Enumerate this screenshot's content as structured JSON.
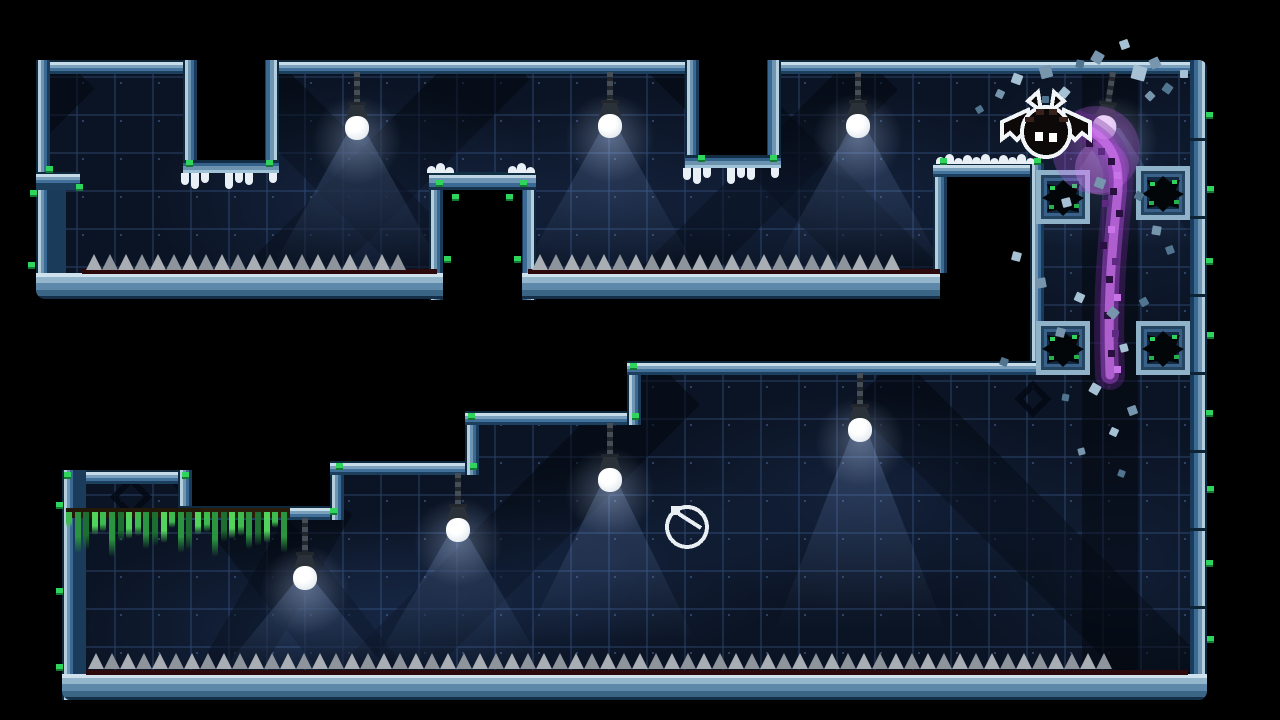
{
  "viewport": {
    "width": 1280,
    "height": 720,
    "background": "#000000"
  },
  "palette": {
    "tile_base": "#0b1424",
    "tile_grid": "#2c4268",
    "border_light": "#c6dbe8",
    "border_mid": "#41719a",
    "border_dark": "#1c3f5e",
    "spike_light": "#a9aeb5",
    "spike_dark": "#8d949c",
    "spike_base_red": "#2e090c",
    "moss_green": "#2fd45c",
    "vine_green": "#3dbb4e",
    "snow_white": "#e9f0f5",
    "lamp_bulb": "#edf1f5",
    "trail_purple": "#a755cc",
    "debris_blue": "#a6c1d4",
    "bat_body": "#0c0908",
    "bat_outline": "#f2f5f7"
  },
  "entities": {
    "bat_player": {
      "x": 998,
      "y": 92,
      "width": 96,
      "height": 68,
      "facing": "left"
    },
    "clock_pickup": {
      "cx": 687,
      "cy": 527,
      "r": 20
    },
    "lamps": [
      {
        "x": 357,
        "attach": 72,
        "bulb": 128,
        "tilt": 0,
        "cone": 140
      },
      {
        "x": 610,
        "attach": 72,
        "bulb": 126,
        "tilt": 0,
        "cone": 140
      },
      {
        "x": 858,
        "attach": 72,
        "bulb": 126,
        "tilt": 0,
        "cone": 140
      },
      {
        "x": 1113,
        "attach": 72,
        "bulb": 128,
        "tilt": 9,
        "cone": 120
      },
      {
        "x": 305,
        "attach": 518,
        "bulb": 578,
        "tilt": 0,
        "cone": 95
      },
      {
        "x": 458,
        "attach": 473,
        "bulb": 530,
        "tilt": 0,
        "cone": 135
      },
      {
        "x": 610,
        "attach": 423,
        "bulb": 480,
        "tilt": 0,
        "cone": 160
      },
      {
        "x": 860,
        "attach": 373,
        "bulb": 430,
        "tilt": 0,
        "cone": 200
      }
    ],
    "spike_rows": [
      {
        "x": 86,
        "y": 253,
        "w": 347
      },
      {
        "x": 532,
        "y": 253,
        "w": 404
      },
      {
        "x": 88,
        "y": 652,
        "w": 1098
      }
    ],
    "red_strips": [
      {
        "x": 82,
        "y": 269,
        "w": 355
      },
      {
        "x": 528,
        "y": 269,
        "w": 412
      },
      {
        "x": 86,
        "y": 670,
        "w": 1102
      }
    ],
    "snow_rows": [
      {
        "x": 427,
        "y": 164,
        "w": 30
      },
      {
        "x": 508,
        "y": 164,
        "w": 30
      },
      {
        "x": 936,
        "y": 155,
        "w": 106
      }
    ],
    "icicle_rows": [
      {
        "x": 181,
        "y": 173,
        "w": 98
      },
      {
        "x": 683,
        "y": 168,
        "w": 98
      }
    ],
    "vines": {
      "x": 66,
      "y": 508,
      "w": 224,
      "beam_h": 10
    },
    "anchor_blocks": [
      {
        "x": 1036,
        "y": 170,
        "s": 54
      },
      {
        "x": 1136,
        "y": 166,
        "s": 54
      },
      {
        "x": 1036,
        "y": 321,
        "s": 54
      },
      {
        "x": 1136,
        "y": 321,
        "s": 54
      }
    ],
    "chain_decals": [
      {
        "x": 131,
        "y": 497,
        "s": 30
      },
      {
        "x": 1033,
        "y": 399,
        "s": 26
      }
    ],
    "moss": [
      [
        46,
        166
      ],
      [
        76,
        184
      ],
      [
        186,
        160
      ],
      [
        266,
        160
      ],
      [
        698,
        155
      ],
      [
        770,
        155
      ],
      [
        436,
        180
      ],
      [
        452,
        194
      ],
      [
        506,
        194
      ],
      [
        520,
        180
      ],
      [
        444,
        256
      ],
      [
        514,
        256
      ],
      [
        64,
        472
      ],
      [
        182,
        472
      ],
      [
        188,
        508
      ],
      [
        330,
        508
      ],
      [
        336,
        463
      ],
      [
        470,
        463
      ],
      [
        468,
        413
      ],
      [
        632,
        413
      ],
      [
        630,
        363
      ],
      [
        940,
        158
      ],
      [
        1034,
        158
      ],
      [
        1206,
        112
      ],
      [
        1207,
        186
      ],
      [
        1206,
        258
      ],
      [
        1207,
        332
      ],
      [
        1206,
        410
      ],
      [
        1207,
        486
      ],
      [
        1206,
        560
      ],
      [
        1207,
        636
      ],
      [
        56,
        502
      ],
      [
        56,
        588
      ],
      [
        56,
        664
      ],
      [
        30,
        190
      ],
      [
        28,
        262
      ]
    ],
    "debris": [
      [
        1012,
        74,
        10,
        20,
        0
      ],
      [
        1040,
        66,
        12,
        -15,
        1
      ],
      [
        1060,
        88,
        9,
        40,
        0
      ],
      [
        1076,
        60,
        8,
        10,
        2
      ],
      [
        1092,
        52,
        11,
        30,
        1
      ],
      [
        1120,
        40,
        9,
        -20,
        0
      ],
      [
        1042,
        96,
        7,
        0,
        2
      ],
      [
        996,
        90,
        8,
        25,
        1
      ],
      [
        976,
        106,
        7,
        -30,
        2
      ],
      [
        1132,
        66,
        14,
        15,
        0
      ],
      [
        1150,
        58,
        10,
        -25,
        1
      ],
      [
        1163,
        84,
        9,
        35,
        2
      ],
      [
        1180,
        70,
        8,
        0,
        0
      ],
      [
        1146,
        92,
        8,
        45,
        1
      ],
      [
        1095,
        178,
        10,
        20,
        1
      ],
      [
        1062,
        198,
        9,
        -15,
        0
      ],
      [
        1135,
        192,
        8,
        30,
        2
      ],
      [
        1152,
        226,
        9,
        10,
        1
      ],
      [
        1166,
        246,
        8,
        -20,
        2
      ],
      [
        1012,
        252,
        9,
        15,
        0
      ],
      [
        1036,
        278,
        10,
        -10,
        1
      ],
      [
        1075,
        293,
        9,
        25,
        0
      ],
      [
        1108,
        308,
        10,
        40,
        1
      ],
      [
        1140,
        298,
        8,
        -30,
        2
      ],
      [
        1056,
        328,
        9,
        15,
        1
      ],
      [
        1120,
        344,
        8,
        -15,
        0
      ],
      [
        1000,
        358,
        8,
        20,
        2
      ],
      [
        1090,
        384,
        10,
        30,
        0
      ],
      [
        1128,
        406,
        9,
        -20,
        1
      ],
      [
        1062,
        394,
        7,
        10,
        2
      ],
      [
        1110,
        428,
        8,
        25,
        0
      ],
      [
        1078,
        448,
        7,
        -15,
        1
      ],
      [
        1118,
        470,
        7,
        20,
        2
      ]
    ],
    "debris_colors": [
      "#a6c1d4",
      "#7796ad",
      "#52758f"
    ],
    "dust_trail": {
      "path": "M1080,126 C1112,138 1122,162 1117,200 C1112,250 1107,300 1110,375",
      "dither": [
        [
          1086,
          140,
          0
        ],
        [
          1098,
          148,
          1
        ],
        [
          1108,
          158,
          0
        ],
        [
          1114,
          172,
          2
        ],
        [
          1110,
          188,
          0
        ],
        [
          1102,
          200,
          1
        ],
        [
          1116,
          210,
          0
        ],
        [
          1108,
          226,
          2
        ],
        [
          1100,
          242,
          0
        ],
        [
          1112,
          258,
          1
        ],
        [
          1106,
          276,
          0
        ],
        [
          1114,
          294,
          2
        ],
        [
          1104,
          312,
          0
        ],
        [
          1112,
          330,
          1
        ],
        [
          1108,
          350,
          0
        ],
        [
          1114,
          366,
          2
        ]
      ],
      "dither_colors": [
        "#2a1040",
        "#5c2a80",
        "#c873e8"
      ]
    },
    "beams": [
      [
        40,
        66,
        64,
        340,
        45
      ],
      [
        200,
        60,
        64,
        360,
        -45
      ],
      [
        470,
        55,
        70,
        400,
        45
      ],
      [
        640,
        50,
        70,
        420,
        -45
      ],
      [
        850,
        70,
        56,
        320,
        45
      ],
      [
        140,
        430,
        70,
        330,
        -38
      ],
      [
        640,
        380,
        70,
        430,
        45
      ],
      [
        840,
        380,
        70,
        430,
        -45
      ],
      [
        300,
        500,
        56,
        280,
        30
      ]
    ],
    "washes": [
      [
        357,
        200,
        210,
        120,
        0.16
      ],
      [
        610,
        200,
        200,
        110,
        0.14
      ],
      [
        858,
        200,
        200,
        110,
        0.14
      ],
      [
        1110,
        200,
        160,
        140,
        0.12
      ],
      [
        305,
        630,
        240,
        110,
        0.16
      ],
      [
        458,
        600,
        200,
        100,
        0.13
      ],
      [
        610,
        560,
        200,
        100,
        0.13
      ],
      [
        860,
        500,
        220,
        110,
        0.14
      ],
      [
        1120,
        560,
        180,
        140,
        0.1
      ]
    ],
    "wall_seg_lines_y": [
      138,
      216,
      294,
      372,
      450,
      528,
      606
    ]
  }
}
